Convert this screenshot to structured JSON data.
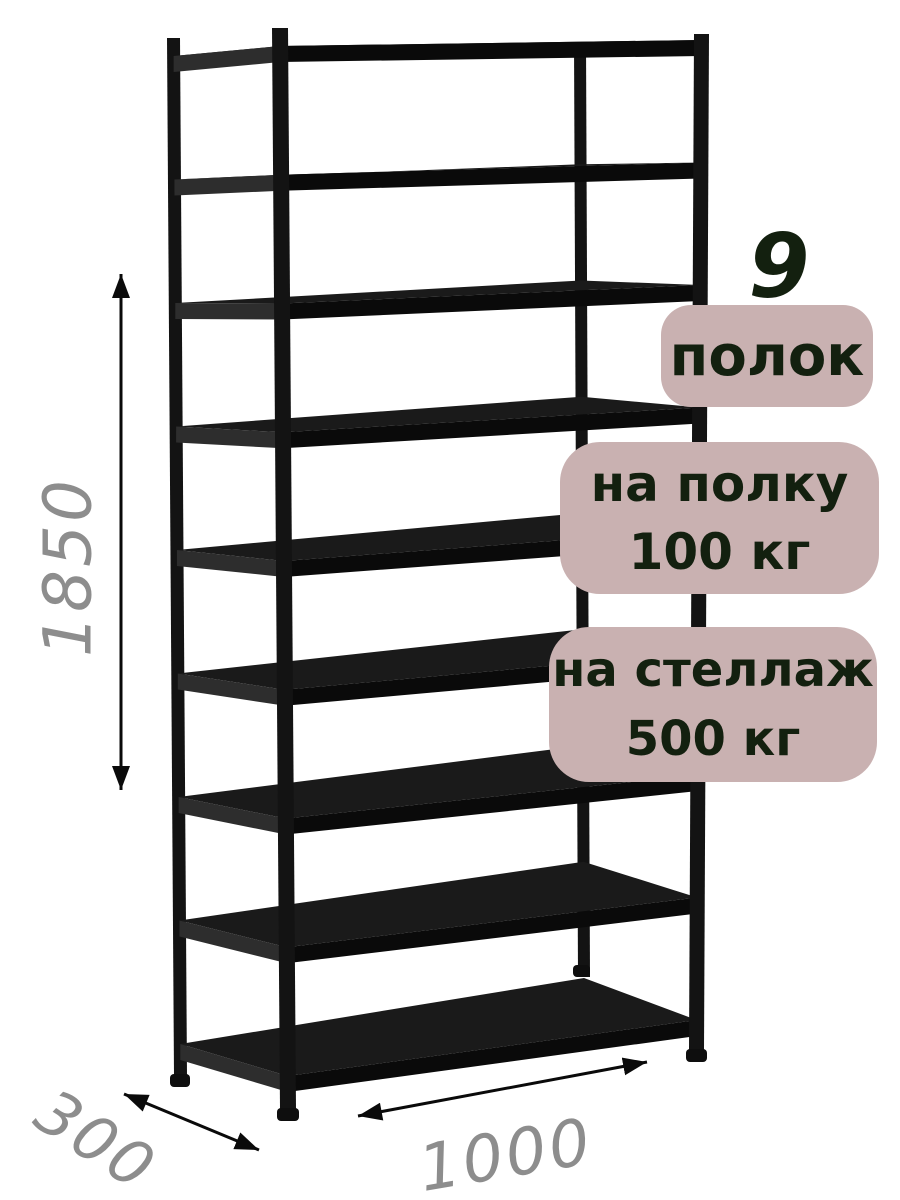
{
  "canvas": {
    "background": "#ffffff"
  },
  "rack": {
    "shelf_count": 9,
    "color_post": "#131313",
    "color_front_edge": "#0a0a0a",
    "color_surface": "#1a1a1a",
    "color_side_edge": "#2d2d2d",
    "color_foot": "#0e0e0e"
  },
  "dimensions": {
    "height": "1850",
    "depth": "300",
    "width": "1000",
    "text_color": "#8d8d8d",
    "arrow_color": "#0a0a0a"
  },
  "callouts": {
    "bg": "#c9b1b1",
    "text_color": "#13200f",
    "count_number": "9",
    "count_label": "полок",
    "shelf_load_line1": "на полку",
    "shelf_load_line2": "100 кг",
    "rack_load_line1": "на стеллаж",
    "rack_load_line2": "500 кг"
  }
}
